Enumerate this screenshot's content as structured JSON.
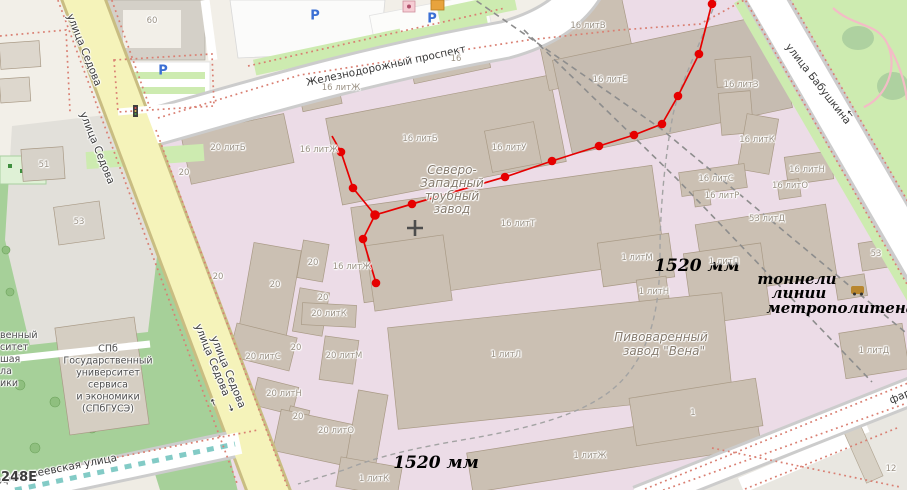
{
  "streets": {
    "sedova": "улица Седова",
    "zheleznodorozhny": "Железнодорожный проспект",
    "babushkina": "улица Бабушкина",
    "varfolomeevskaya": "Варфоломеевская улица",
    "far": "фар"
  },
  "places": {
    "factory": [
      "Северо-",
      "Западный",
      "трубный",
      "завод"
    ],
    "brewery": [
      "Пивоваренный",
      "завод \"Вена\""
    ],
    "university": [
      "СПб",
      "Государственный",
      "университет",
      "сервиса",
      "и экономики",
      "(СПбГУСЭ)"
    ],
    "left_fragments": [
      "венный",
      "ситет",
      "шая",
      "ла",
      "ики"
    ],
    "watermark": "1248Е"
  },
  "annotations": {
    "gauge_top": "1520 мм",
    "gauge_bottom": "1520 мм",
    "tunnels": [
      "тоннели",
      "линии",
      "метрополитена"
    ]
  },
  "icons": {
    "parking": "P",
    "arrow": "→"
  },
  "colors": {
    "industrial": "#ecdce7",
    "building": "#cbc0b3",
    "road_yellow": "#f5f3ba",
    "park": "#a6d099",
    "park_light": "#cdebb0",
    "red_line": "#e60000",
    "tunnel_dash": "#8d8d8d",
    "boundary_dots": "#d97f72",
    "tram": "#83cbc6"
  },
  "building_labels": [
    {
      "text": "60",
      "x": 152,
      "y": 21
    },
    {
      "text": "20 литБ",
      "x": 228,
      "y": 148
    },
    {
      "text": "16 литЖ",
      "x": 341,
      "y": 88
    },
    {
      "text": "16",
      "x": 456,
      "y": 59
    },
    {
      "text": "16 литВ",
      "x": 588,
      "y": 26
    },
    {
      "text": "16 литБ",
      "x": 420,
      "y": 139
    },
    {
      "text": "16 литУ",
      "x": 509,
      "y": 148
    },
    {
      "text": "16 литЕ",
      "x": 610,
      "y": 80
    },
    {
      "text": "16 литЗ",
      "x": 741,
      "y": 85
    },
    {
      "text": "16 литЖ",
      "x": 319,
      "y": 150
    },
    {
      "text": "16 литК",
      "x": 757,
      "y": 140
    },
    {
      "text": "16 литН",
      "x": 807,
      "y": 170
    },
    {
      "text": "16 литС",
      "x": 716,
      "y": 179
    },
    {
      "text": "16 литО",
      "x": 790,
      "y": 186
    },
    {
      "text": "16 литР",
      "x": 722,
      "y": 196
    },
    {
      "text": "53 литД",
      "x": 767,
      "y": 219
    },
    {
      "text": "16 литТ",
      "x": 518,
      "y": 224
    },
    {
      "text": "53",
      "x": 876,
      "y": 254
    },
    {
      "text": "1 литМ",
      "x": 637,
      "y": 258
    },
    {
      "text": "1 литН",
      "x": 654,
      "y": 292
    },
    {
      "text": "1 литП",
      "x": 724,
      "y": 262
    },
    {
      "text": "16 литЖ",
      "x": 352,
      "y": 267
    },
    {
      "text": "20",
      "x": 313,
      "y": 263
    },
    {
      "text": "20",
      "x": 275,
      "y": 285
    },
    {
      "text": "20",
      "x": 323,
      "y": 298
    },
    {
      "text": "20 литК",
      "x": 329,
      "y": 314
    },
    {
      "text": "20",
      "x": 296,
      "y": 348
    },
    {
      "text": "20 литМ",
      "x": 344,
      "y": 356
    },
    {
      "text": "20 литС",
      "x": 263,
      "y": 357
    },
    {
      "text": "20 литН",
      "x": 284,
      "y": 394
    },
    {
      "text": "20",
      "x": 298,
      "y": 417
    },
    {
      "text": "20 литО",
      "x": 336,
      "y": 431
    },
    {
      "text": "20",
      "x": 184,
      "y": 173
    },
    {
      "text": "20",
      "x": 218,
      "y": 277
    },
    {
      "text": "51",
      "x": 44,
      "y": 165
    },
    {
      "text": "53",
      "x": 79,
      "y": 222
    },
    {
      "text": "1 литЛ",
      "x": 506,
      "y": 355
    },
    {
      "text": "1 литЖ",
      "x": 590,
      "y": 456
    },
    {
      "text": "1 литК",
      "x": 374,
      "y": 479
    },
    {
      "text": "1 литД",
      "x": 874,
      "y": 351
    },
    {
      "text": "1",
      "x": 693,
      "y": 413
    },
    {
      "text": "12",
      "x": 891,
      "y": 469
    }
  ]
}
